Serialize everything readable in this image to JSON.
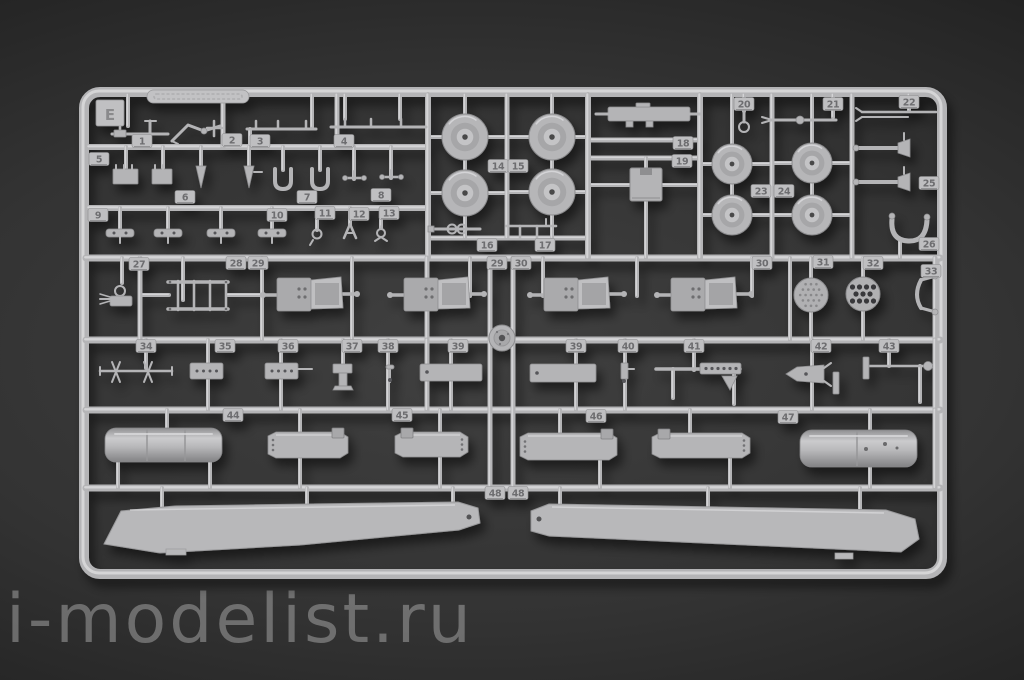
{
  "scene": {
    "description": "photograph of a light-gray injection-molded plastic model kit sprue on a dark backdrop"
  },
  "watermark": {
    "text": "i-modelist.ru"
  },
  "sprue": {
    "letter": "E",
    "part_tags": [
      {
        "label": "1",
        "x": 142,
        "y": 141
      },
      {
        "label": "2",
        "x": 232,
        "y": 140
      },
      {
        "label": "3",
        "x": 260,
        "y": 141
      },
      {
        "label": "4",
        "x": 344,
        "y": 141
      },
      {
        "label": "5",
        "x": 99,
        "y": 159
      },
      {
        "label": "6",
        "x": 185,
        "y": 197
      },
      {
        "label": "7",
        "x": 307,
        "y": 197
      },
      {
        "label": "8",
        "x": 381,
        "y": 195
      },
      {
        "label": "9",
        "x": 98,
        "y": 215
      },
      {
        "label": "10",
        "x": 277,
        "y": 215
      },
      {
        "label": "11",
        "x": 325,
        "y": 213
      },
      {
        "label": "12",
        "x": 359,
        "y": 214
      },
      {
        "label": "13",
        "x": 389,
        "y": 213
      },
      {
        "label": "14",
        "x": 498,
        "y": 166
      },
      {
        "label": "15",
        "x": 518,
        "y": 166
      },
      {
        "label": "16",
        "x": 487,
        "y": 245
      },
      {
        "label": "17",
        "x": 545,
        "y": 245
      },
      {
        "label": "18",
        "x": 683,
        "y": 143
      },
      {
        "label": "19",
        "x": 682,
        "y": 161
      },
      {
        "label": "20",
        "x": 744,
        "y": 104
      },
      {
        "label": "21",
        "x": 833,
        "y": 104
      },
      {
        "label": "22",
        "x": 909,
        "y": 102
      },
      {
        "label": "23",
        "x": 761,
        "y": 191
      },
      {
        "label": "24",
        "x": 784,
        "y": 191
      },
      {
        "label": "25",
        "x": 929,
        "y": 183
      },
      {
        "label": "26",
        "x": 929,
        "y": 244
      },
      {
        "label": "27",
        "x": 139,
        "y": 264
      },
      {
        "label": "28",
        "x": 236,
        "y": 263
      },
      {
        "label": "29",
        "x": 258,
        "y": 263
      },
      {
        "label": "29",
        "x": 497,
        "y": 263
      },
      {
        "label": "30",
        "x": 521,
        "y": 263
      },
      {
        "label": "30",
        "x": 762,
        "y": 263
      },
      {
        "label": "31",
        "x": 823,
        "y": 262
      },
      {
        "label": "32",
        "x": 873,
        "y": 263
      },
      {
        "label": "33",
        "x": 931,
        "y": 271
      },
      {
        "label": "34",
        "x": 146,
        "y": 346
      },
      {
        "label": "35",
        "x": 225,
        "y": 346
      },
      {
        "label": "36",
        "x": 288,
        "y": 346
      },
      {
        "label": "37",
        "x": 352,
        "y": 346
      },
      {
        "label": "38",
        "x": 388,
        "y": 346
      },
      {
        "label": "39",
        "x": 458,
        "y": 346
      },
      {
        "label": "39",
        "x": 576,
        "y": 346
      },
      {
        "label": "40",
        "x": 628,
        "y": 346
      },
      {
        "label": "41",
        "x": 694,
        "y": 346
      },
      {
        "label": "42",
        "x": 821,
        "y": 346
      },
      {
        "label": "43",
        "x": 889,
        "y": 346
      },
      {
        "label": "44",
        "x": 233,
        "y": 415
      },
      {
        "label": "45",
        "x": 402,
        "y": 415
      },
      {
        "label": "46",
        "x": 596,
        "y": 416
      },
      {
        "label": "47",
        "x": 788,
        "y": 417
      },
      {
        "label": "48",
        "x": 495,
        "y": 493
      },
      {
        "label": "48",
        "x": 518,
        "y": 493
      }
    ],
    "duplicate_tagged_parts": [
      "29",
      "30",
      "39",
      "48"
    ],
    "notable_parts": {
      "small_wheels": "4 road wheels near parts 14/15",
      "large_wheels": "4 wheels near parts 23/24",
      "seats": "4 crew seats near parts 29/30",
      "perforated_discs": "2 mesh discs, parts 31/32",
      "fuel_tanks": "2 cylindrical tanks, parts 44/47",
      "rotor_blades": "2 long rotor blades, part 48"
    },
    "colors": {
      "plastic": "#b4b4b6",
      "plastic_highlight": "#dadadc",
      "plastic_shadow": "#8e8e90",
      "plastic_dark": "#57575a",
      "tag_fill": "#bfbfc1",
      "tag_text": "#6d6d6f",
      "background": "#2e2e2e",
      "watermark": "#acacac"
    }
  }
}
